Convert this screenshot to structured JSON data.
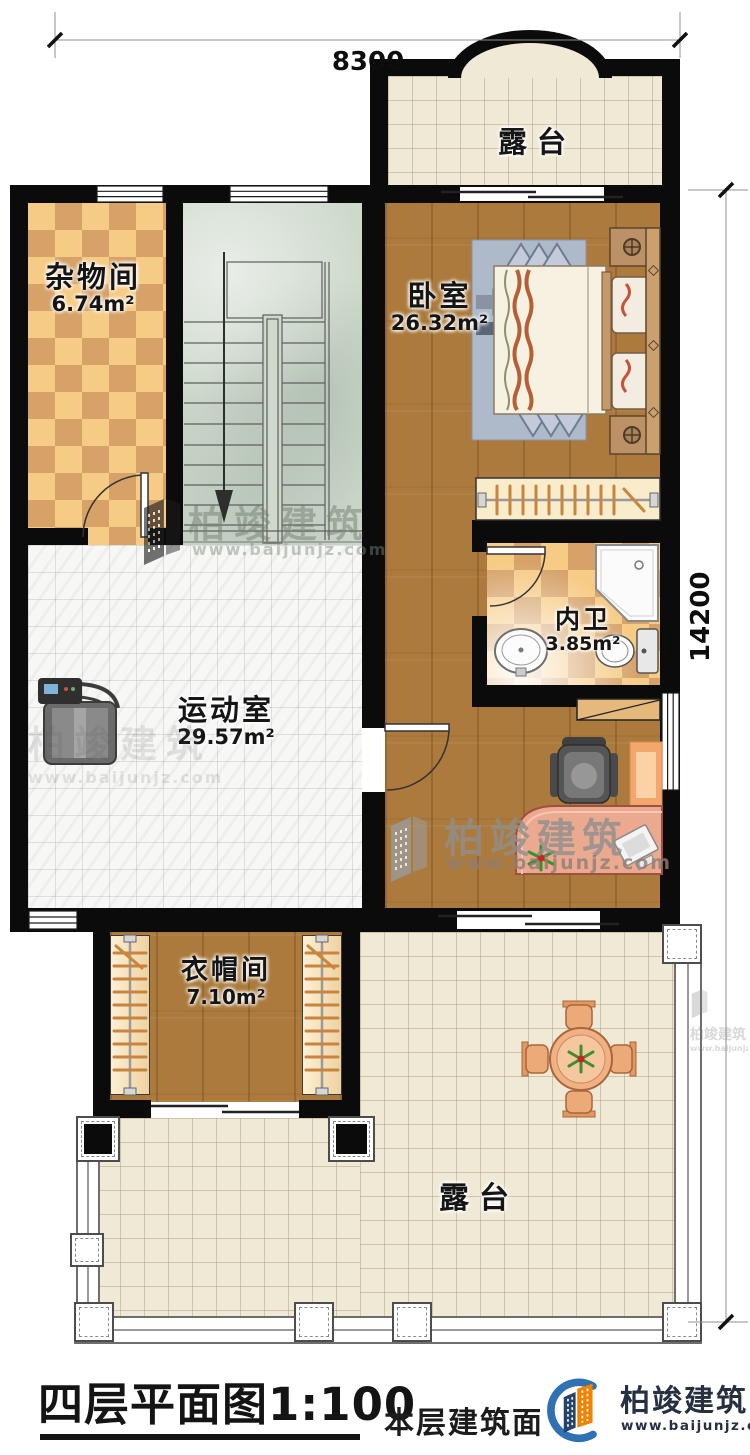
{
  "dimensions": {
    "width_top": "8300",
    "height_right": "14200"
  },
  "rooms": {
    "terrace_top": {
      "label": "露台"
    },
    "storage": {
      "label": "杂物间",
      "area": "6.74m²"
    },
    "bedroom": {
      "label": "卧室",
      "area": "26.32m²"
    },
    "bathroom": {
      "label": "内卫",
      "area": "3.85m²"
    },
    "gym": {
      "label": "运动室",
      "area": "29.57m²"
    },
    "cloakroom": {
      "label": "衣帽间",
      "area": "7.10m²"
    },
    "terrace_bottom": {
      "label": "露台"
    }
  },
  "watermark": {
    "brand": "柏竣建筑",
    "url": "www.baijunjz.com"
  },
  "footer": {
    "plan_title": "四层平面图1:100",
    "area_note": "本层建筑面积",
    "brand": "柏竣建筑",
    "url": "www.baijunjz.com"
  },
  "colors": {
    "wall": "#0b0b0b",
    "wood": "#ac7a3c",
    "terrace_tile": "#efe9d5",
    "checker_light": "#f6cb85",
    "checker_dark": "#d6a268",
    "stair_floor": "#ced9cc",
    "brand_navy": "#273040",
    "brand_orange": "#f08300",
    "brand_blue": "#2f72b4"
  }
}
